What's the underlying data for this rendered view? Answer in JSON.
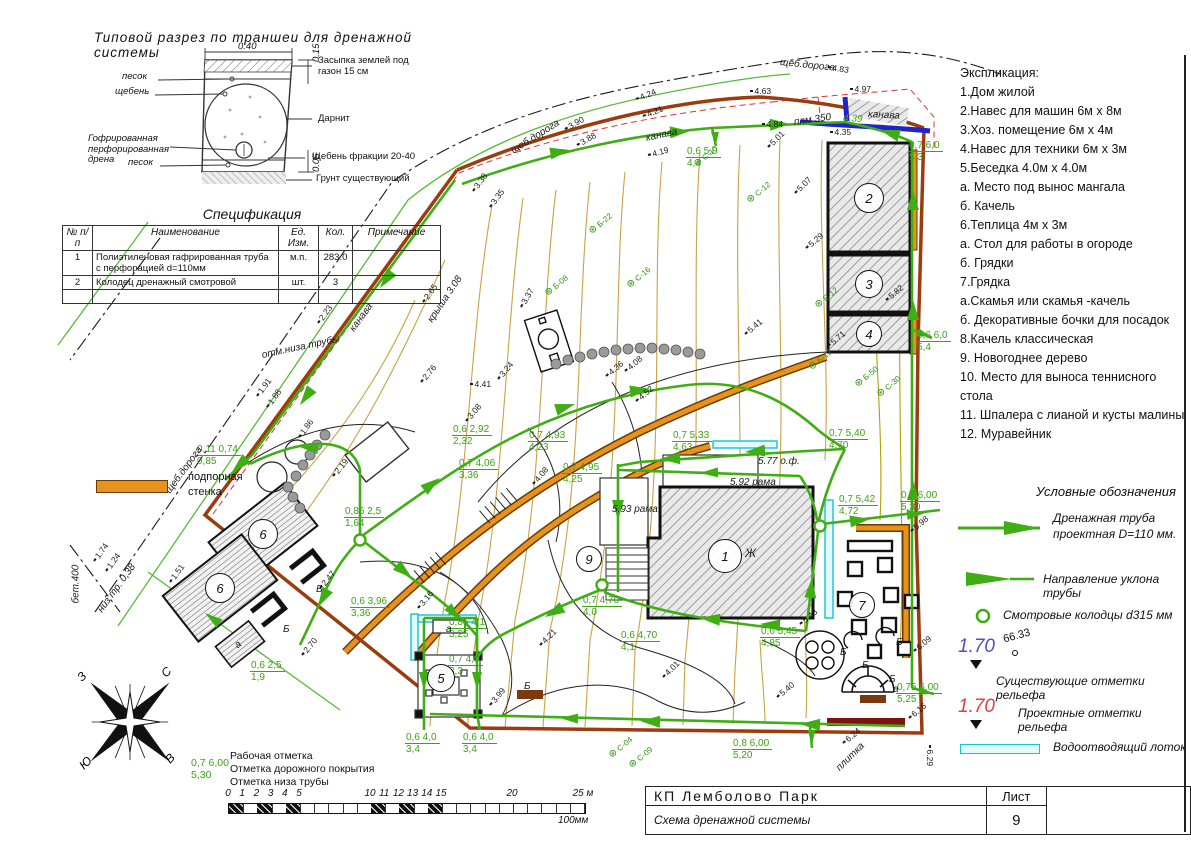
{
  "section": {
    "title": "Типовой разрез по траншеи для дренажной системы",
    "dim_top": "0.40",
    "dim_right_top": "0.15",
    "dim_right_bottom": "0.05",
    "labels_left": [
      "песок",
      "щебень",
      "Гофрированная перфорированная дрена",
      "песок"
    ],
    "labels_right": [
      "Засыпка землей под газон 15 см",
      "Дарнит",
      "Щебень фракции 20-40",
      "Грунт существующий"
    ]
  },
  "spec": {
    "title": "Спецификация",
    "headers": [
      "№ п/п",
      "Наименование",
      "Ед. Изм.",
      "Кол.",
      "Примечание"
    ],
    "rows": [
      {
        "n": "1",
        "name": "Полиэтиленовая гафрированная труба с перфорацией d=110мм",
        "unit": "м.п.",
        "qty": "283.0",
        "note": ""
      },
      {
        "n": "2",
        "name": "Колодец дренажный смотровой",
        "unit": "шт.",
        "qty": "3",
        "note": ""
      }
    ]
  },
  "explication": {
    "title": "Экспликация:",
    "items": [
      "1.Дом жилой",
      "2.Навес для машин 6м х 8м",
      "3.Хоз. помещение 6м х 4м",
      "4.Навес для техники 6м х 3м",
      "5.Беседка 4.0м х 4.0м",
      "а. Место под вынос мангала",
      "б. Качель",
      "6.Теплица 4м х 3м",
      "а. Стол для работы в огороде",
      "б. Грядки",
      "7.Грядка",
      "а.Скамья или скамья -качель",
      "б. Декоративные бочки для посадок",
      "8.Качель классическая",
      "9. Новогоднее дерево",
      "10. Место для выноса теннисного стола",
      "11. Шпалера с лианой и кусты малины",
      "12. Муравейник"
    ]
  },
  "legend": {
    "title": "Условные обозначения",
    "pipe_label": "Дренажная труба проектная D=110 мм.",
    "slope_label": "Направление уклона трубы",
    "well_label": "Смотровые колодцы  d315 мм",
    "existing_value": "1.70",
    "existing_spot": "66.33",
    "existing_label": "Существующие отметки рельефа",
    "design_value": "1.70",
    "design_label": "Проектные отметки рельефа",
    "tray_label": "Водоотводящий лоток",
    "wall_label": "подпорная стенка"
  },
  "notes": {
    "example_top": "0,7 6,00",
    "example_bottom": "5,30",
    "line1": "Рабочая отметка",
    "line2": "Отметка дорожного покрытия",
    "line3": "Отметка низа трубы"
  },
  "scalebar": {
    "unit_px": 14.2,
    "labels": [
      [
        "0",
        0
      ],
      [
        "1",
        1
      ],
      [
        "2",
        2
      ],
      [
        "3",
        3
      ],
      [
        "4",
        4
      ],
      [
        "5",
        5
      ],
      [
        "10",
        10
      ],
      [
        "11",
        11
      ],
      [
        "12",
        12
      ],
      [
        "13",
        13
      ],
      [
        "14",
        14
      ],
      [
        "15",
        15
      ],
      [
        "20",
        20
      ],
      [
        "25 м",
        25
      ]
    ],
    "black_cells": [
      0,
      2,
      4,
      10,
      12,
      14
    ],
    "caption": "100мм"
  },
  "titleblock": {
    "project": "КП  Лемболово  Парк",
    "sheet_word": "Лист",
    "doc_title": "Схема дренажной системы",
    "sheet_num": "9"
  },
  "compass": {
    "n": "С",
    "e": "В",
    "s": "Ю",
    "w": "З"
  },
  "plan": {
    "house_mark": "Ж",
    "number_circles": [
      {
        "x": 725,
        "y": 556,
        "t": "1",
        "r": 16
      },
      {
        "x": 869,
        "y": 198,
        "t": "2",
        "r": 14
      },
      {
        "x": 869,
        "y": 284,
        "t": "3",
        "r": 13
      },
      {
        "x": 869,
        "y": 334,
        "t": "4",
        "r": 12
      },
      {
        "x": 441,
        "y": 678,
        "t": "5",
        "r": 13
      },
      {
        "x": 263,
        "y": 534,
        "t": "6",
        "r": 14
      },
      {
        "x": 220,
        "y": 588,
        "t": "6",
        "r": 14
      },
      {
        "x": 862,
        "y": 605,
        "t": "7",
        "r": 12
      },
      {
        "x": 589,
        "y": 559,
        "t": "9",
        "r": 12
      }
    ],
    "pipe_labels": [
      {
        "x": 196,
        "y": 444,
        "a": "0,11 0,74",
        "b": "0,85"
      },
      {
        "x": 344,
        "y": 506,
        "a": "0,86 2,5",
        "b": "1,64"
      },
      {
        "x": 250,
        "y": 660,
        "a": "0,6 2,5",
        "b": "1,9"
      },
      {
        "x": 350,
        "y": 596,
        "a": "0,6 3,96",
        "b": "3,36"
      },
      {
        "x": 452,
        "y": 424,
        "a": "0,6 2,92",
        "b": "2,32"
      },
      {
        "x": 458,
        "y": 458,
        "a": "0,7 4,06",
        "b": "3,36"
      },
      {
        "x": 528,
        "y": 430,
        "a": "0,7 4,93",
        "b": "4,23"
      },
      {
        "x": 562,
        "y": 462,
        "a": "0,7 4,95",
        "b": "4,25"
      },
      {
        "x": 672,
        "y": 430,
        "a": "0,7 5,33",
        "b": "4,63"
      },
      {
        "x": 828,
        "y": 428,
        "a": "0,7 5,40",
        "b": "4,70"
      },
      {
        "x": 838,
        "y": 494,
        "a": "0,7 5,42",
        "b": "4,72"
      },
      {
        "x": 900,
        "y": 490,
        "a": "0,7 6,00",
        "b": "5,30"
      },
      {
        "x": 760,
        "y": 626,
        "a": "0,6 5,45",
        "b": "4,85"
      },
      {
        "x": 620,
        "y": 630,
        "a": "0,6 4,70",
        "b": "4,1"
      },
      {
        "x": 582,
        "y": 595,
        "a": "0,7 4,70",
        "b": "4,0"
      },
      {
        "x": 448,
        "y": 617,
        "a": "0,85 4,1",
        "b": "3,25"
      },
      {
        "x": 448,
        "y": 654,
        "a": "0,7 4,0",
        "b": "3,3"
      },
      {
        "x": 405,
        "y": 732,
        "a": "0,6 4,0",
        "b": "3,4"
      },
      {
        "x": 462,
        "y": 732,
        "a": "0,6 4,0",
        "b": "3,4"
      },
      {
        "x": 686,
        "y": 146,
        "a": "0,6 5,0",
        "b": "4,4"
      },
      {
        "x": 908,
        "y": 140,
        "a": "0,7 6,0",
        "b": "5,3"
      },
      {
        "x": 916,
        "y": 330,
        "a": "0,6 6,0",
        "b": "5,4"
      },
      {
        "x": 896,
        "y": 682,
        "a": "0,75 6,00",
        "b": "5,25"
      },
      {
        "x": 732,
        "y": 738,
        "a": "0,8 6,00",
        "b": "5,20"
      }
    ],
    "spots": [
      {
        "x": 473,
        "y": 186,
        "r": -54,
        "t": "3.38"
      },
      {
        "x": 490,
        "y": 202,
        "r": -54,
        "t": "3.35"
      },
      {
        "x": 257,
        "y": 391,
        "r": -54,
        "t": "1.91"
      },
      {
        "x": 267,
        "y": 402,
        "r": -54,
        "t": "1.88"
      },
      {
        "x": 299,
        "y": 432,
        "r": -54,
        "t": "1.86"
      },
      {
        "x": 94,
        "y": 556,
        "r": -54,
        "t": "1.74"
      },
      {
        "x": 106,
        "y": 566,
        "r": -54,
        "t": "1.24"
      },
      {
        "x": 170,
        "y": 577,
        "r": -54,
        "t": "1.51"
      },
      {
        "x": 318,
        "y": 318,
        "r": -54,
        "t": "2.23"
      },
      {
        "x": 423,
        "y": 297,
        "r": -54,
        "t": "2.65"
      },
      {
        "x": 565,
        "y": 124,
        "r": -30,
        "t": "3.90"
      },
      {
        "x": 577,
        "y": 140,
        "r": -30,
        "t": "3.88"
      },
      {
        "x": 636,
        "y": 94,
        "r": -22,
        "t": "4.24"
      },
      {
        "x": 643,
        "y": 111,
        "r": -22,
        "t": "4.21"
      },
      {
        "x": 648,
        "y": 150,
        "r": -15,
        "t": "4.19"
      },
      {
        "x": 750,
        "y": 86,
        "r": 0,
        "t": "4.63"
      },
      {
        "x": 762,
        "y": 119,
        "r": 0,
        "t": "4.84"
      },
      {
        "x": 828,
        "y": 62,
        "r": 8,
        "t": "4.83"
      },
      {
        "x": 850,
        "y": 84,
        "r": 0,
        "t": "4.97"
      },
      {
        "x": 830,
        "y": 127,
        "r": 0,
        "t": "4.35"
      },
      {
        "x": 768,
        "y": 142,
        "r": -45,
        "t": "5.01"
      },
      {
        "x": 795,
        "y": 188,
        "r": -45,
        "t": "5.07"
      },
      {
        "x": 333,
        "y": 471,
        "r": -50,
        "t": "2.19"
      },
      {
        "x": 320,
        "y": 583,
        "r": -50,
        "t": "2.47"
      },
      {
        "x": 302,
        "y": 650,
        "r": -50,
        "t": "2.70"
      },
      {
        "x": 421,
        "y": 377,
        "r": -50,
        "t": "2.76"
      },
      {
        "x": 466,
        "y": 416,
        "r": -50,
        "t": "3.08"
      },
      {
        "x": 498,
        "y": 374,
        "r": -50,
        "t": "3.24"
      },
      {
        "x": 521,
        "y": 302,
        "r": -60,
        "t": "3.37"
      },
      {
        "x": 470,
        "y": 379,
        "r": 0,
        "t": "4.41"
      },
      {
        "x": 533,
        "y": 479,
        "r": -50,
        "t": "4.08"
      },
      {
        "x": 418,
        "y": 603,
        "r": -50,
        "t": "3.16"
      },
      {
        "x": 490,
        "y": 700,
        "r": -50,
        "t": "3.99"
      },
      {
        "x": 540,
        "y": 640,
        "r": -45,
        "t": "4.21"
      },
      {
        "x": 663,
        "y": 672,
        "r": -45,
        "t": "4.01"
      },
      {
        "x": 606,
        "y": 371,
        "r": -40,
        "t": "4.36"
      },
      {
        "x": 625,
        "y": 366,
        "r": -40,
        "t": "4.08"
      },
      {
        "x": 636,
        "y": 396,
        "r": -40,
        "t": "4.52"
      },
      {
        "x": 745,
        "y": 329,
        "r": -40,
        "t": "5.41"
      },
      {
        "x": 806,
        "y": 243,
        "r": -40,
        "t": "5.29"
      },
      {
        "x": 886,
        "y": 295,
        "r": -40,
        "t": "5.82"
      },
      {
        "x": 828,
        "y": 341,
        "r": -40,
        "t": "5.71"
      },
      {
        "x": 911,
        "y": 526,
        "r": -40,
        "t": "5.98"
      },
      {
        "x": 914,
        "y": 646,
        "r": -40,
        "t": "6.09"
      },
      {
        "x": 800,
        "y": 619,
        "r": -40,
        "t": "5.43"
      },
      {
        "x": 777,
        "y": 692,
        "r": -40,
        "t": "5.40"
      },
      {
        "x": 843,
        "y": 738,
        "r": -40,
        "t": "6.24"
      },
      {
        "x": 909,
        "y": 713,
        "r": -40,
        "t": "6.16"
      },
      {
        "x": 930,
        "y": 740,
        "r": 90,
        "t": "6.29"
      }
    ],
    "texts": [
      {
        "x": 168,
        "y": 487,
        "r": -54,
        "t": "щеб.дорога",
        "c": "k"
      },
      {
        "x": 512,
        "y": 146,
        "r": -32,
        "t": "щеб.дорога",
        "c": "k"
      },
      {
        "x": 780,
        "y": 57,
        "r": 6,
        "t": "щеб.дорога",
        "c": "k"
      },
      {
        "x": 352,
        "y": 325,
        "r": -54,
        "t": "канава",
        "c": "k"
      },
      {
        "x": 646,
        "y": 133,
        "r": -12,
        "t": "канава",
        "c": "k"
      },
      {
        "x": 868,
        "y": 109,
        "r": 3,
        "t": "канава",
        "c": "k"
      },
      {
        "x": 843,
        "y": 113,
        "r": 3,
        "t": "4.39",
        "c": "g"
      },
      {
        "x": 794,
        "y": 117,
        "r": -8,
        "t": "плм 350",
        "c": "k"
      },
      {
        "x": 838,
        "y": 764,
        "r": -45,
        "t": "плитка",
        "c": "k"
      },
      {
        "x": 76,
        "y": 598,
        "r": -90,
        "t": "бет.400",
        "c": "k"
      },
      {
        "x": 100,
        "y": 606,
        "r": -54,
        "t": "низ тр. 0,38",
        "c": "k"
      },
      {
        "x": 262,
        "y": 350,
        "r": -12,
        "t": "отм.низа трубы",
        "c": "k"
      },
      {
        "x": 430,
        "y": 316,
        "r": -56,
        "t": "крыша 3.08",
        "c": "k"
      },
      {
        "x": 283,
        "y": 624,
        "r": 0,
        "t": "Б",
        "c": "k"
      },
      {
        "x": 316,
        "y": 584,
        "r": 0,
        "t": "Б",
        "c": "k"
      },
      {
        "x": 524,
        "y": 681,
        "r": 0,
        "t": "Б",
        "c": "k"
      },
      {
        "x": 840,
        "y": 647,
        "r": 0,
        "t": "Б",
        "c": "k"
      },
      {
        "x": 896,
        "y": 637,
        "r": 0,
        "t": "Б",
        "c": "k"
      },
      {
        "x": 862,
        "y": 660,
        "r": 0,
        "t": "Б",
        "c": "k"
      },
      {
        "x": 889,
        "y": 674,
        "r": 0,
        "t": "Б",
        "c": "k"
      },
      {
        "x": 236,
        "y": 641,
        "r": -38,
        "t": "а",
        "c": "k"
      },
      {
        "x": 446,
        "y": 624,
        "r": 0,
        "t": "а",
        "c": "k"
      },
      {
        "x": 893,
        "y": 684,
        "r": 0,
        "t": "а",
        "c": "k"
      },
      {
        "x": 612,
        "y": 504,
        "r": 0,
        "t": "5.93  рама",
        "c": "k"
      },
      {
        "x": 730,
        "y": 477,
        "r": 0,
        "t": "5.92  рама",
        "c": "k"
      },
      {
        "x": 758,
        "y": 456,
        "r": 0,
        "t": "5.77 о.ф.",
        "c": "k"
      }
    ],
    "plants": [
      {
        "x": 695,
        "y": 160,
        "t": "С-10"
      },
      {
        "x": 748,
        "y": 196,
        "t": "С-12"
      },
      {
        "x": 546,
        "y": 289,
        "t": "Б-08"
      },
      {
        "x": 590,
        "y": 227,
        "t": "Б-22"
      },
      {
        "x": 628,
        "y": 281,
        "t": "С-16"
      },
      {
        "x": 816,
        "y": 301,
        "t": "Е-12"
      },
      {
        "x": 856,
        "y": 380,
        "t": "Б-50"
      },
      {
        "x": 878,
        "y": 390,
        "t": "С-30"
      },
      {
        "x": 610,
        "y": 751,
        "t": "С-04"
      },
      {
        "x": 630,
        "y": 761,
        "t": "С-09"
      },
      {
        "x": 810,
        "y": 363,
        "t": "Б-12"
      }
    ]
  }
}
